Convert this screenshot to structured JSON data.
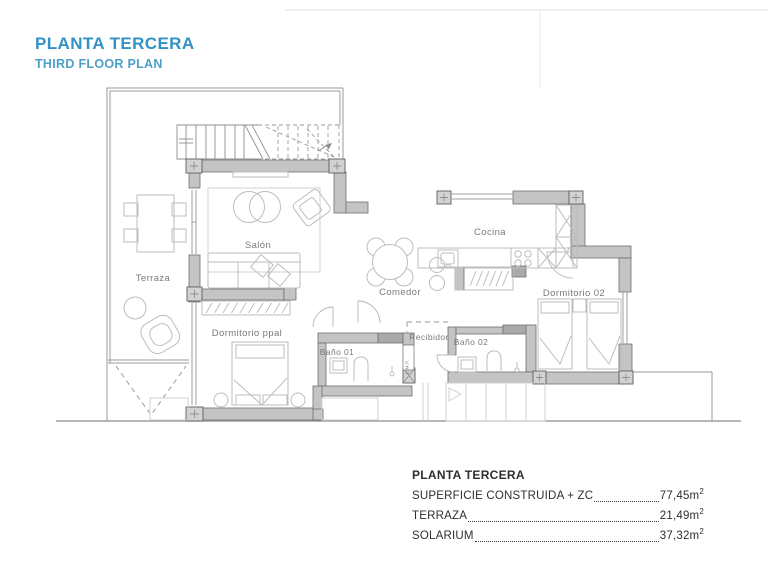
{
  "title": {
    "main": "PLANTA TERCERA",
    "sub": "THIRD FLOOR PLAN"
  },
  "rooms": {
    "terraza": "Terraza",
    "salon": "Salón",
    "comedor": "Comedor",
    "cocina": "Cocina",
    "dormitorio_ppal": "Dormitorio ppal",
    "dormitorio_02": "Dormitorio 02",
    "recibidor": "Recibidor",
    "bano_01": "Baño 01",
    "bano_02": "Baño 02",
    "cmp": "C.M.P."
  },
  "legend": {
    "title": "PLANTA TERCERA",
    "rows": [
      {
        "label": "SUPERFICIE CONSTRUIDA + ZC",
        "value": "77,45m",
        "sup": "2"
      },
      {
        "label": "TERRAZA",
        "value": "21,49m",
        "sup": "2"
      },
      {
        "label": "SOLARIUM",
        "value": "37,32m",
        "sup": "2"
      }
    ]
  },
  "colors": {
    "accent_blue": "#3292c4",
    "accent_blue_light": "#4d9fc7",
    "wall_gray": "#c4c4c4",
    "pillar_gray": "#d2d2d2",
    "line_gray": "#9a9a9a",
    "label_gray": "#7a7a7a",
    "text_dark": "#2f2f2f"
  }
}
